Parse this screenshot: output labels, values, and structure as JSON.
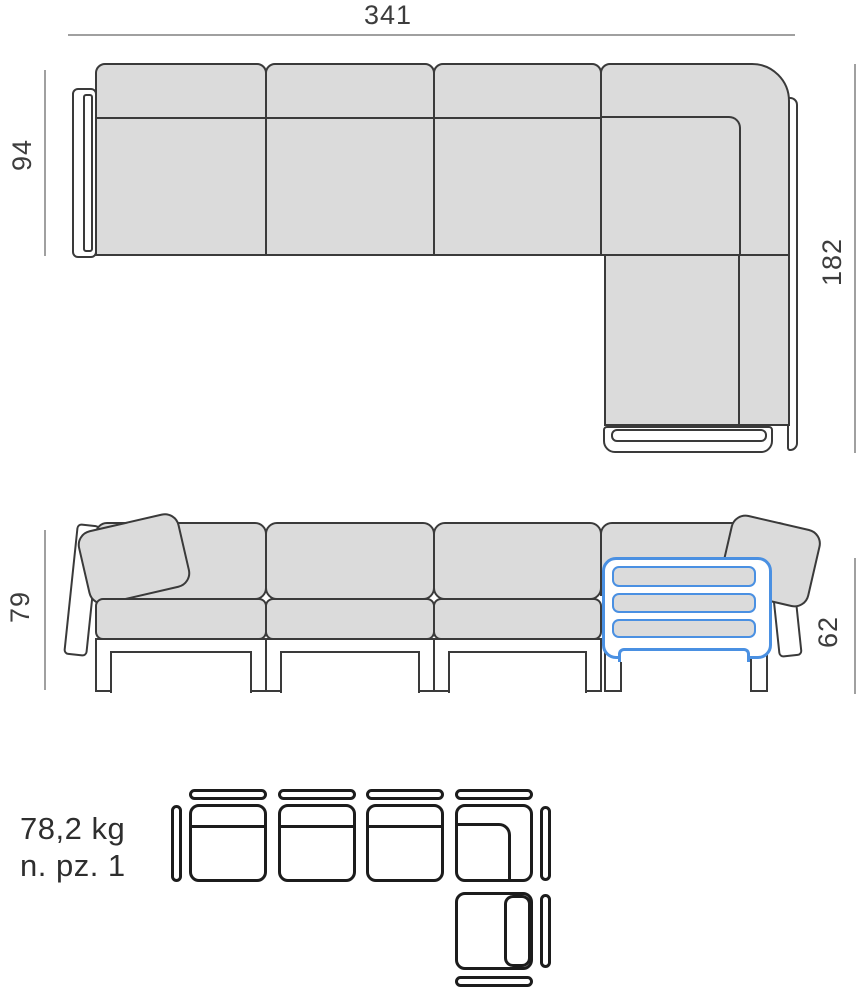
{
  "dimensions": {
    "total_width": "341",
    "side_depth": "94",
    "chaise_depth": "182",
    "back_height": "79",
    "arm_height": "62"
  },
  "specs": {
    "weight": "78,2 kg",
    "pieces": "n. pz. 1"
  },
  "colors": {
    "accent": "#4a90e2",
    "cushion": "#dbdbdb",
    "outline": "#3a3a3a"
  }
}
